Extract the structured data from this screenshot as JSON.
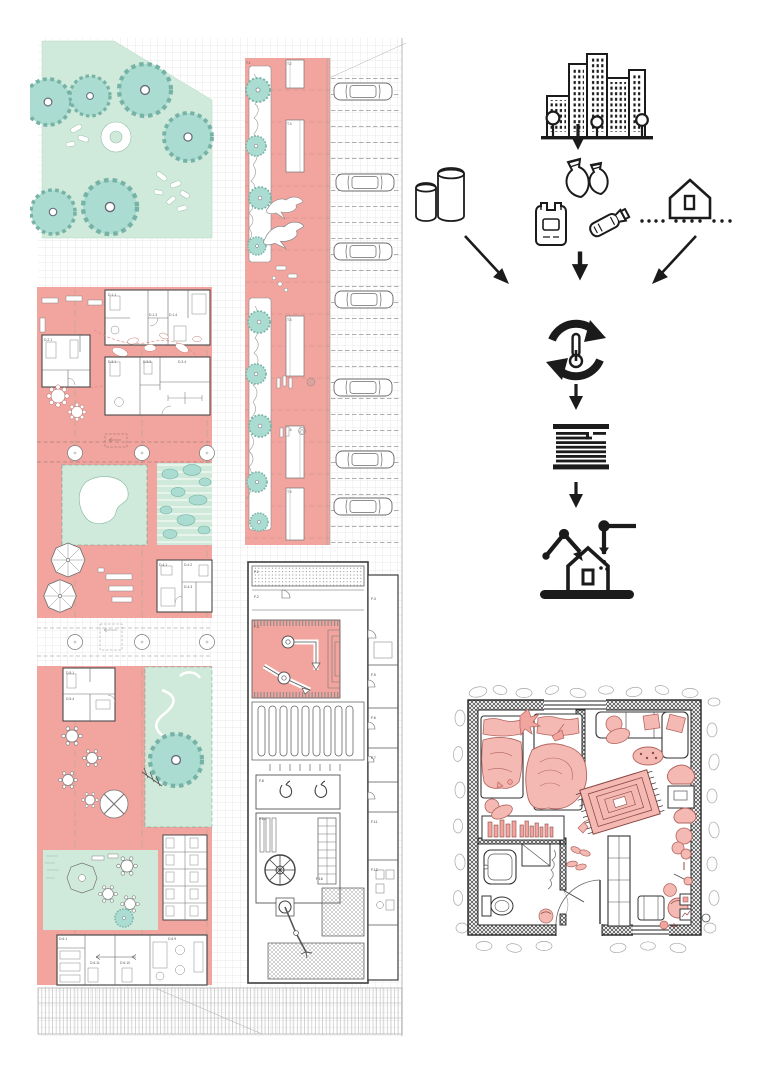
{
  "palette": {
    "pink": "#F2A49E",
    "pink_soft": "#F5B9B3",
    "green": "#CFE9DA",
    "teal": "#ABDCD1",
    "ink": "#1B1B1B",
    "linework": "#5A5A5A",
    "grid": "#D6D6D6"
  },
  "masterplan": {
    "name": "site-masterplan",
    "planter_labels": [
      "T.1",
      "T.2",
      "T.3",
      "T.5",
      "T.8",
      "T.9"
    ],
    "dwelling_labels": [
      "D.1.1",
      "D.1.3",
      "D.1.4",
      "D.2.1",
      "D.3.1",
      "D.3.3",
      "D.3.4",
      "D.4.1",
      "D.4.2",
      "D.4.3",
      "D.5.1",
      "D.5.4",
      "D.6.1",
      "D.6.9",
      "D.6.10",
      "D.6.11"
    ],
    "factory_labels": [
      "F.1",
      "F.2",
      "F.4",
      "F.8",
      "F.10",
      "F.16",
      "F.3",
      "F.5",
      "F.6",
      "F.7",
      "F.11",
      "F.12"
    ]
  },
  "process_diagram": {
    "name": "plastic-recycling-construction-flow",
    "steps": [
      {
        "icon": "city-icon"
      },
      {
        "icon": "down-arrow-icon"
      },
      {
        "icon": "waste-bags-icon"
      },
      {
        "icon": "plastic-bag-icon"
      },
      {
        "icon": "plastic-bottle-icon"
      },
      {
        "icon": "silos-icon"
      },
      {
        "icon": "house-site-dotted-icon"
      },
      {
        "icon": "converging-arrows-icon"
      },
      {
        "icon": "recycle-thermometer-icon"
      },
      {
        "icon": "material-layers-icon"
      },
      {
        "icon": "robotic-arms-house-icon"
      }
    ]
  },
  "room_plan": {
    "name": "apartment-floor-plan"
  }
}
